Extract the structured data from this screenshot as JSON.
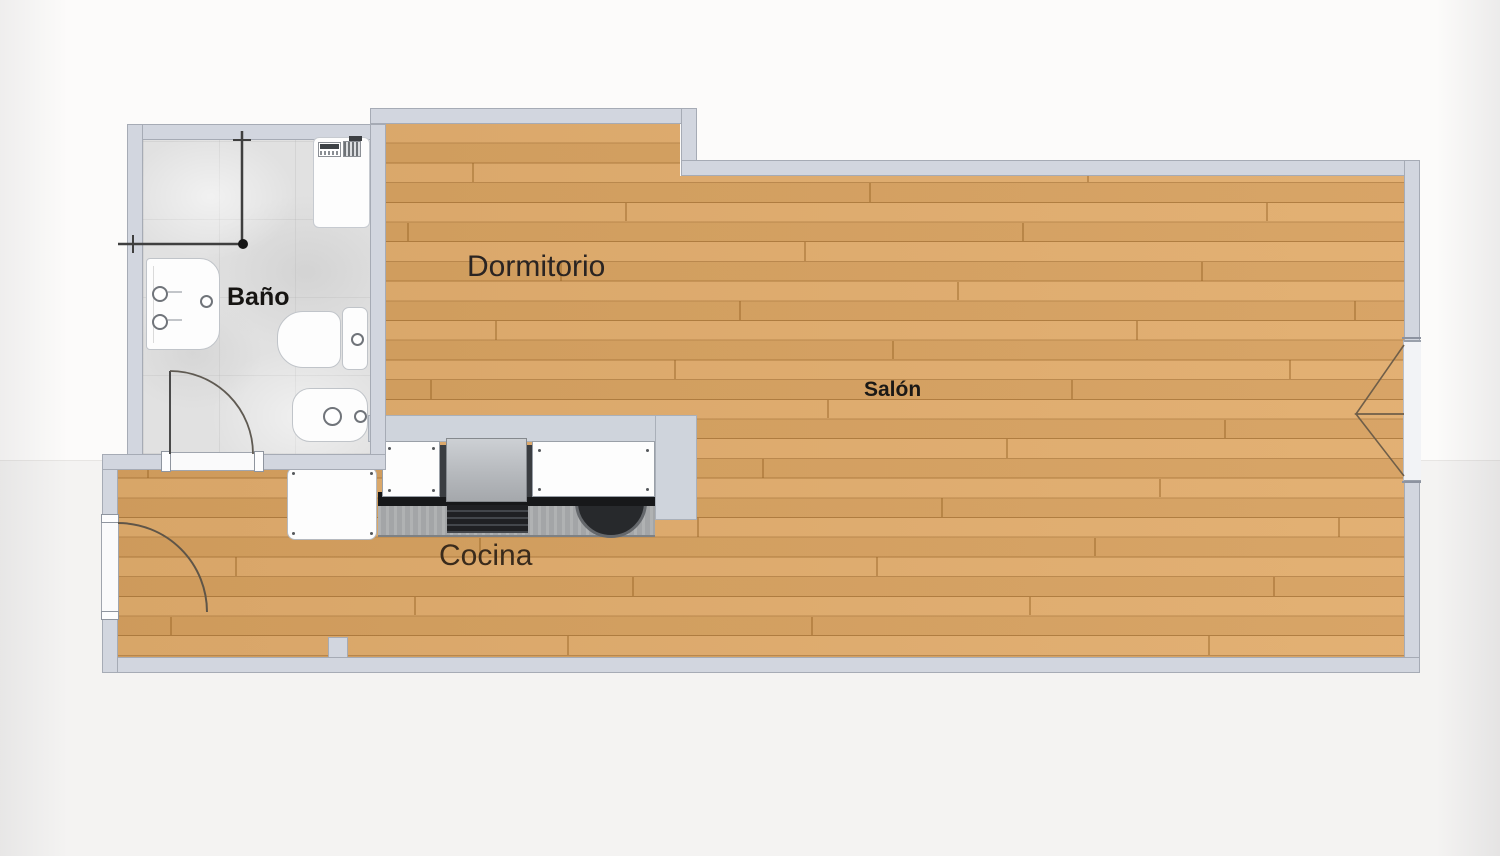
{
  "rooms": {
    "dormitorio": {
      "label": "Dormitorio"
    },
    "bano": {
      "label": "Baño"
    },
    "salon": {
      "label": "Salón"
    },
    "cocina": {
      "label": "Cocina"
    }
  },
  "colors": {
    "wall_fill": "#d2d6df",
    "wall_outline": "#a6abb5",
    "wood_base": "#dfa763",
    "wood_plank_line": "#976326",
    "bathroom_tile": "#e1e1e1",
    "fixture_white": "#fdfdfd",
    "counter_gray": "#a3a5a7",
    "appliance_gray": "#b4b7bb",
    "cooktop_black": "#1f2023",
    "label_regular": "#2a2422",
    "label_bold": "#161412",
    "label_cocina": "#3a2b1c"
  }
}
